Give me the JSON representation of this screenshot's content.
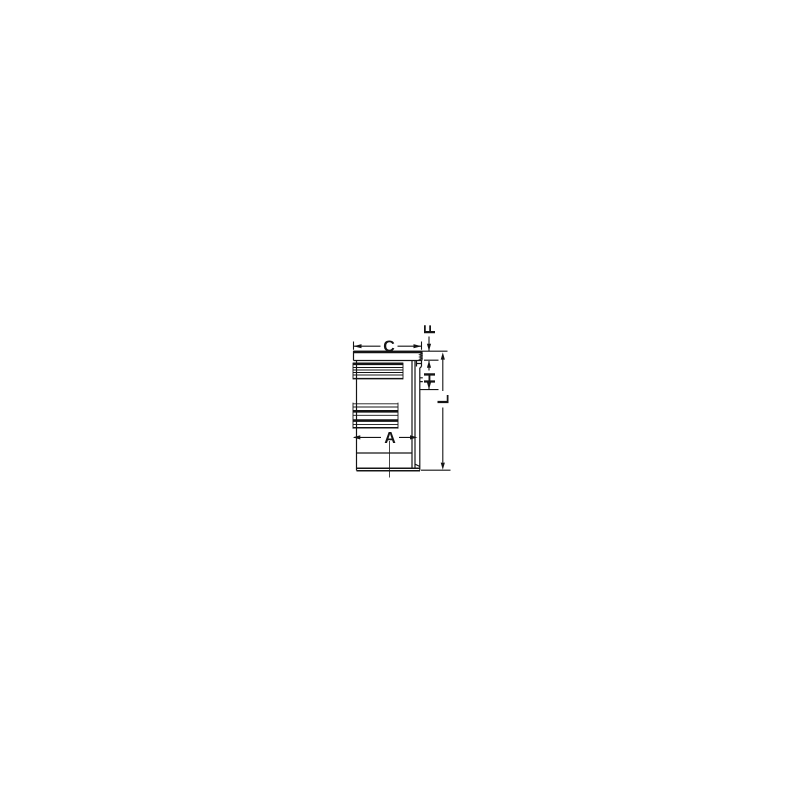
{
  "page": {
    "background_color": "#ffffff"
  },
  "drawing": {
    "kind": "cylinder-liner-dimension-diagram",
    "line_color": "#141414",
    "labels": {
      "c": "C",
      "f": "F",
      "h": "H",
      "a": "A",
      "l": "L"
    }
  }
}
